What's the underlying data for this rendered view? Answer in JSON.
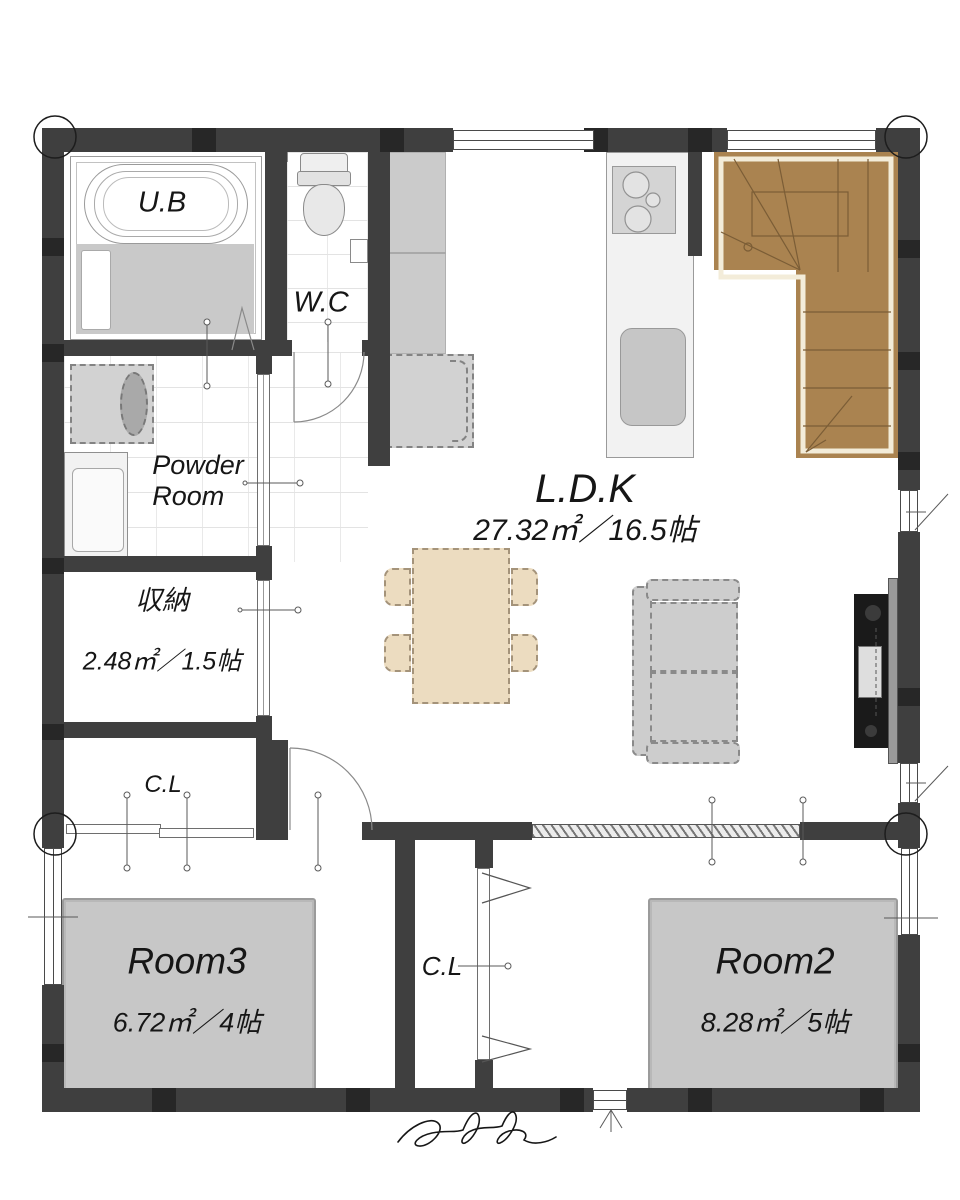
{
  "rooms": {
    "ub": {
      "label": "U.B"
    },
    "wc": {
      "label": "W.C"
    },
    "powder_room": {
      "label": "Powder\nRoom"
    },
    "storage": {
      "label": "収納",
      "area": "2.48㎡／1.5帖"
    },
    "closet_hall": {
      "label": "C.L"
    },
    "ldk": {
      "label": "L.D.K",
      "area": "27.32㎡／16.5帖"
    },
    "closet_center": {
      "label": "C.L"
    },
    "room3": {
      "label": "Room3",
      "area": "6.72㎡／4帖"
    },
    "room2": {
      "label": "Room2",
      "area": "8.28㎡／5帖"
    }
  },
  "signature": "Casa Garage",
  "colors": {
    "wall": "#3f3f3f",
    "stairs_fill": "#aa8350",
    "stairs_trim": "#f3ecd9",
    "mat_gray": "#c7c7c7",
    "table_tan": "#ecdcc0",
    "tv_black": "#1a1a1a"
  }
}
